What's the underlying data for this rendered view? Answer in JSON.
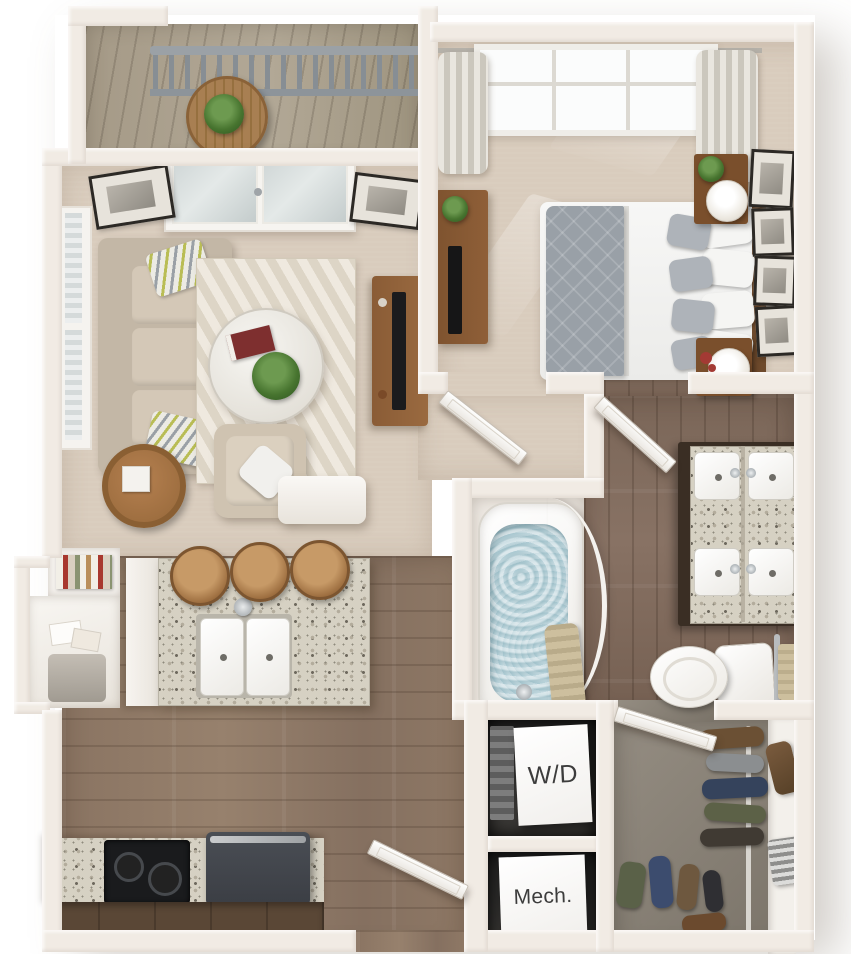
{
  "floorplan": {
    "labels": {
      "washer_dryer": "W/D",
      "mechanical": "Mech."
    },
    "colors": {
      "background": "#ffffff",
      "wall": "#f1ebe4",
      "carpet": "#d9ccbd",
      "kitchen_wood": "#8d7765",
      "bath_wood": "#7c685a",
      "closet_floor": "#8b8377",
      "granite": "#d6d1c3",
      "island_base": "#f4f1ec",
      "sofa": "#cdc1b0",
      "rug": "#eae3d8",
      "bed_blanket": "#99a0a7",
      "wood_furniture": "#8a5c36",
      "appliance_dark": "#42464d",
      "cooktop": "#1a1b1d",
      "water": "#aac9d2",
      "deck": "#a79d8b",
      "railing": "#878e94",
      "label_text": "#3c3c3c"
    }
  }
}
